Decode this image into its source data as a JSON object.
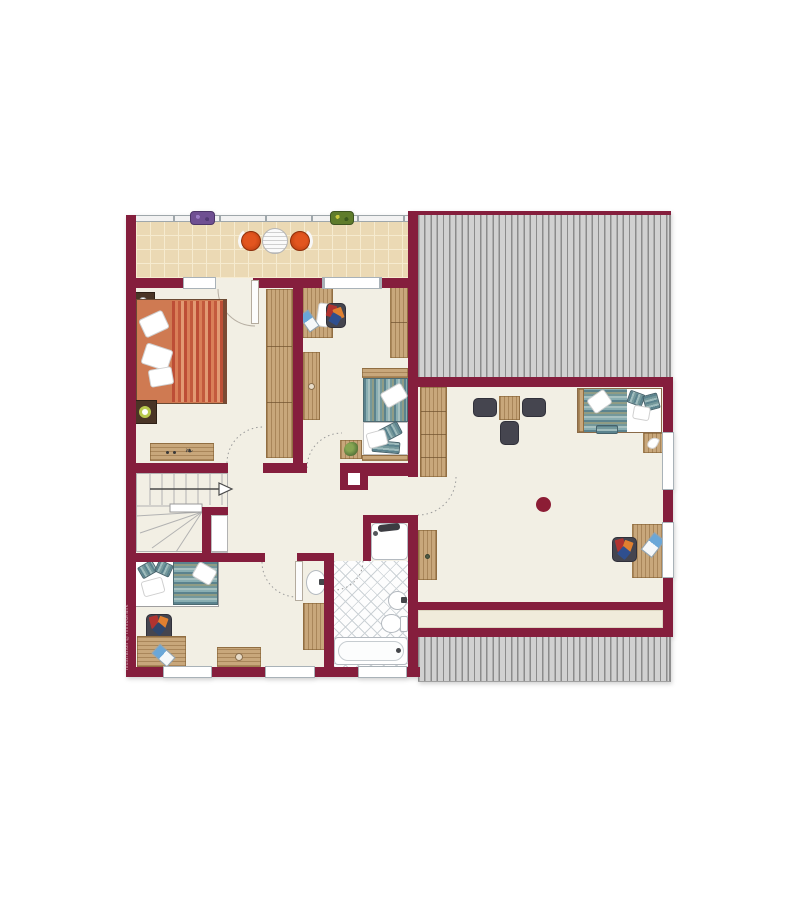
{
  "annotations": {
    "watermark": "Illustration ©ImmoGrafik"
  },
  "palette": {
    "wall": "#851e3d",
    "floor": "#f2efe4",
    "floor2": "#f0ebdb",
    "tile": "#ebd9b4",
    "grout": "#f6ebcf",
    "roofbg": "#d1d1d1",
    "roofline": "#8b8b8b",
    "wood": "#c8a77b",
    "teal2": "#5b838e",
    "olive": "#8f9c85",
    "or1": "#bd4e36",
    "chair": "#45454f",
    "fix": "#b4bac0",
    "flue": "#8c1d35",
    "terrace_chair": "#cc4417",
    "plant_purple": "#6f4f92",
    "plant_green": "#5f7c2b"
  },
  "legend": {
    "areas": [
      "balcony",
      "master-bedroom",
      "kids-room",
      "hallway",
      "staircase",
      "bedroom",
      "wash-niche",
      "bathroom",
      "attic-room",
      "roof-area",
      "storage-strip"
    ],
    "furniture": [
      "double-bed",
      "single-bed",
      "daybed",
      "wardrobe",
      "dresser",
      "nightstand",
      "desk",
      "office-chair",
      "laptop",
      "bookshelf",
      "dining-table",
      "chair",
      "side-table",
      "plant",
      "bathtub",
      "shower",
      "toilet",
      "washbasin",
      "terrace-chair",
      "bistro-table",
      "flower-box",
      "chimney",
      "flue"
    ]
  }
}
